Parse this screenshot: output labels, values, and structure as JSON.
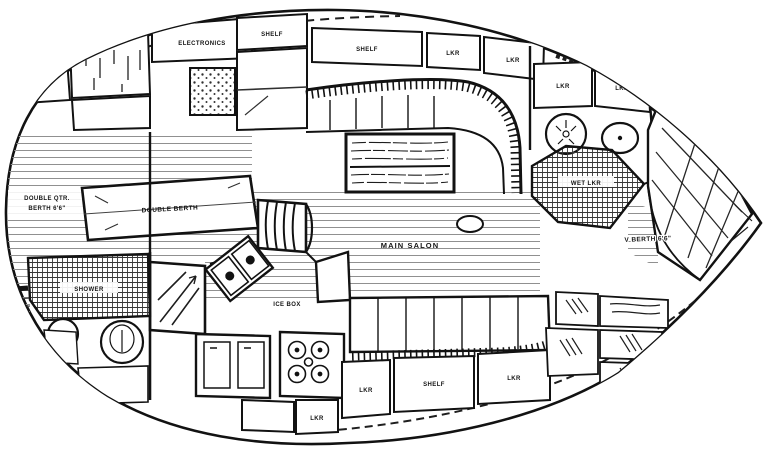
{
  "drawing": {
    "kind": "sailboat interior accommodation plan, scanned line drawing",
    "orientation": "bow to the right, stern to the left",
    "colors": {
      "ink": "#161616",
      "paper": "#ffffff",
      "sole_plank": "#8f8f8f"
    }
  },
  "labels": {
    "lkr_stern_aft": "LKR",
    "electronics": "ELECTRONICS",
    "shelf_port_1": "SHELF",
    "shelf_port_2": "SHELF",
    "lkr_port_1": "LKR",
    "lkr_port_2": "LKR",
    "lkr_head_fwd_1": "LKR",
    "lkr_head_fwd_2": "LKR",
    "aft_berth_line1": "DOUBLE QTR.",
    "aft_berth_line2": "BERTH 6'6\"",
    "double_berth": "DOUBLE BERTH",
    "shower": "SHOWER",
    "ice_box": "ICE BOX",
    "main_salon": "MAIN SALON",
    "wet_lkr": "WET LKR",
    "v_berth": "V BERTH 6'6\"",
    "lkr_galley": "LKR",
    "lkr_stbd_1": "LKR",
    "shelf_stbd": "SHELF",
    "lkr_stbd_2": "LKR"
  }
}
